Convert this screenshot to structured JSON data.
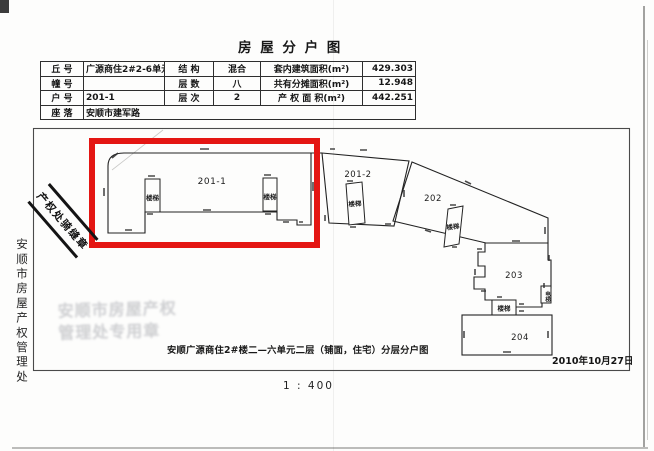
{
  "page": {
    "title": "房 屋 分 户 图",
    "caption": "安顺广源商住2#楼二—六单元二层（铺面，住宅）分层分户图",
    "scale": "1 : 400",
    "date": "2010年10月27日"
  },
  "table": {
    "rows": [
      {
        "k1": "丘 号",
        "v1": "广源商住2#2-6单元",
        "k2": "结 构",
        "v2": "混合",
        "k3": "套内建筑面积(m²)",
        "v3": "429.303"
      },
      {
        "k1": "幢 号",
        "v1": "",
        "k2": "层 数",
        "v2": "八",
        "k3": "共有分摊面积(m²)",
        "v3": "12.948"
      },
      {
        "k1": "户 号",
        "v1": "201-1",
        "k2": "层 次",
        "v2": "2",
        "k3": "产 权 面 积(m²)",
        "v3": "442.251"
      },
      {
        "k1": "座 落",
        "v1": "安顺市建军路"
      }
    ]
  },
  "plan": {
    "units": [
      "201-1",
      "201-2",
      "202",
      "203",
      "204"
    ],
    "stair_label": "楼梯",
    "elevator_label": "电梯"
  },
  "sidebar": {
    "vertical_text": "安顺市房屋产权管理处"
  },
  "stamps": {
    "seam_text": "产权处骑缝章",
    "faint_line1": "安顺市房屋产权",
    "faint_line2": "管理处专用章"
  },
  "colors": {
    "highlight_red": "#e41613"
  }
}
